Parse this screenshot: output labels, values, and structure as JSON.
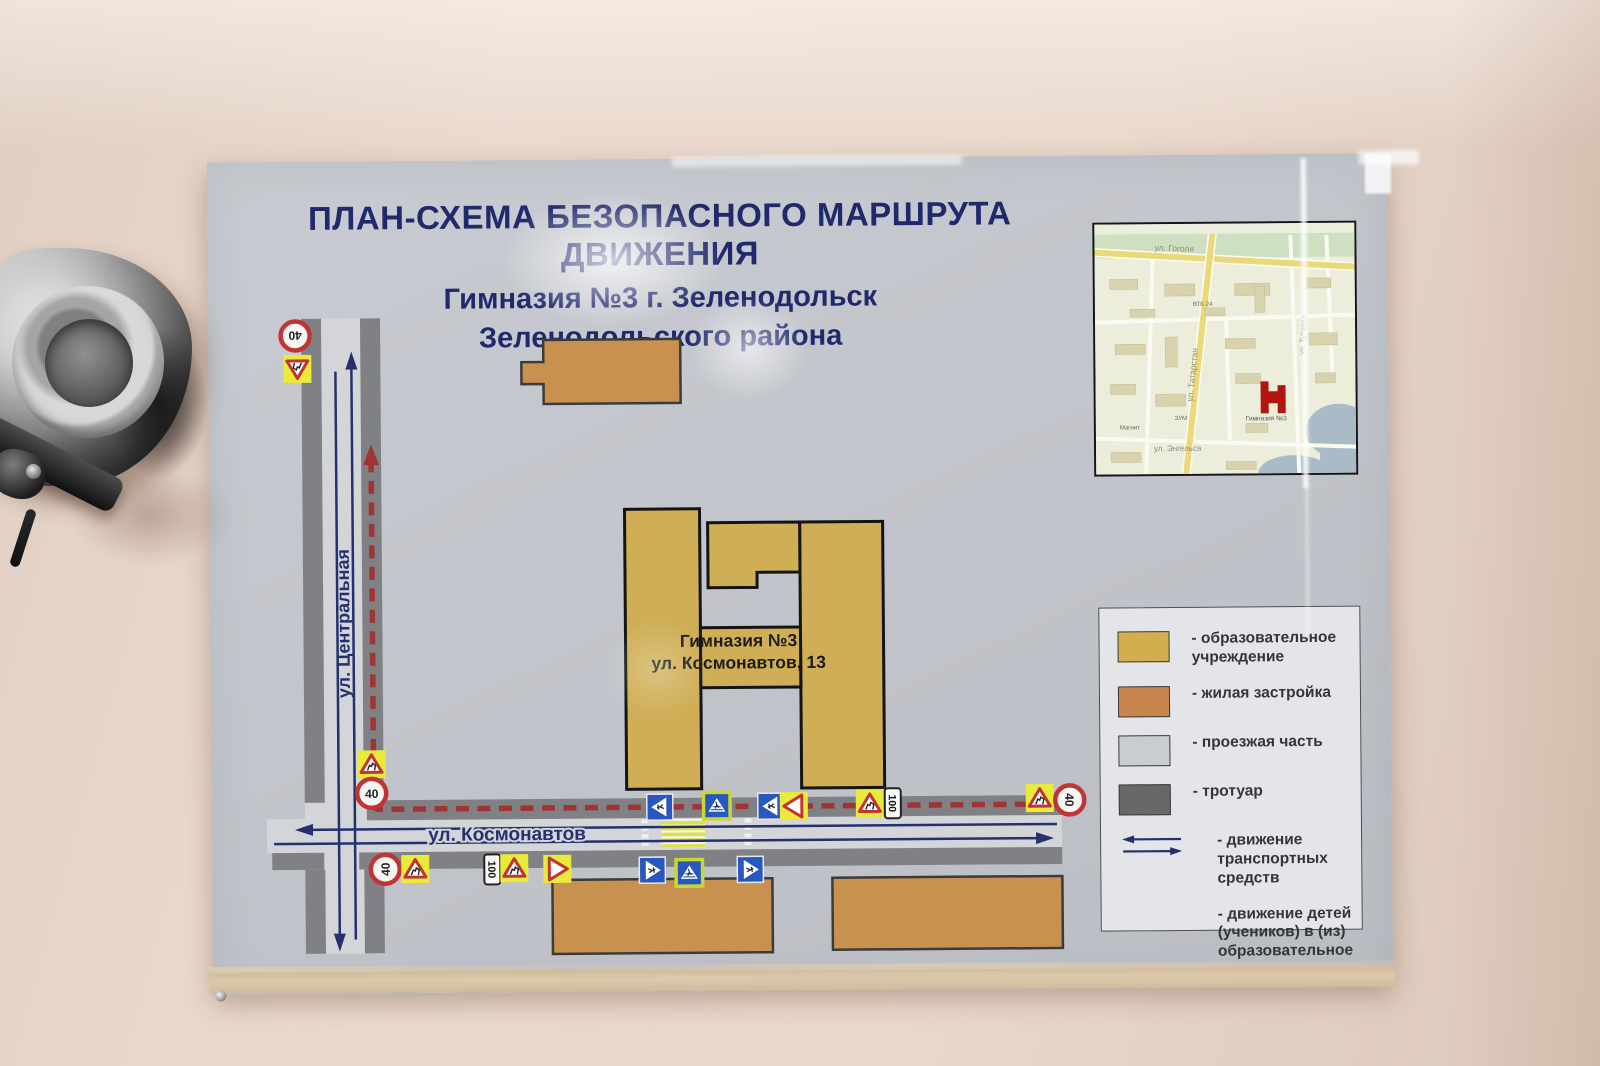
{
  "poster": {
    "title_line1": "ПЛАН-СХЕМА БЕЗОПАСНОГО МАРШРУТА ДВИЖЕНИЯ",
    "title_line2": "Гимназия №3 г. Зеленодольск",
    "title_line3": "Зеленодольского района"
  },
  "map": {
    "street_vertical": "ул. Центральная",
    "street_horizontal": "ул. Космонавтов",
    "school": {
      "line1": "Гимназия №3",
      "line2": "ул. Космонавтов, 13",
      "color": "#cfae55"
    },
    "colors": {
      "residential": "#c9914f",
      "roadway": "#d3d5d9",
      "sidewalk": "#7f8184",
      "route": "#a03434",
      "traffic_arrows": "#26306e"
    },
    "sign_text": {
      "speed": "40",
      "distance": "100"
    },
    "signs": [
      {
        "type": "speed40",
        "x": 87,
        "y": 174,
        "rot": 180
      },
      {
        "type": "children",
        "x": 89,
        "y": 207,
        "rot": 180
      },
      {
        "type": "children",
        "x": 160,
        "y": 603,
        "rot": 0
      },
      {
        "type": "speed40",
        "x": 160,
        "y": 632,
        "rot": 0
      },
      {
        "type": "ped",
        "x": 448,
        "y": 648,
        "rot": -90
      },
      {
        "type": "pedcross",
        "x": 505,
        "y": 647,
        "rot": 0
      },
      {
        "type": "ped",
        "x": 559,
        "y": 648,
        "rot": -90
      },
      {
        "type": "giveway",
        "x": 582,
        "y": 648,
        "rot": 90
      },
      {
        "type": "children",
        "x": 658,
        "y": 646,
        "rot": 0
      },
      {
        "type": "plate100",
        "x": 681,
        "y": 646,
        "rot": 90
      },
      {
        "type": "children",
        "x": 828,
        "y": 642,
        "rot": 0
      },
      {
        "type": "speed40",
        "x": 858,
        "y": 644,
        "rot": 90
      },
      {
        "type": "speed40",
        "x": 173,
        "y": 708,
        "rot": -90
      },
      {
        "type": "children",
        "x": 203,
        "y": 708,
        "rot": 0
      },
      {
        "type": "plate100",
        "x": 280,
        "y": 709,
        "rot": 90
      },
      {
        "type": "children",
        "x": 302,
        "y": 708,
        "rot": 0
      },
      {
        "type": "giveway",
        "x": 345,
        "y": 709,
        "rot": -90
      },
      {
        "type": "ped",
        "x": 440,
        "y": 711,
        "rot": 90
      },
      {
        "type": "pedcross",
        "x": 477,
        "y": 714,
        "rot": 0
      },
      {
        "type": "ped",
        "x": 538,
        "y": 711,
        "rot": 90
      }
    ]
  },
  "inset_map": {
    "street_gogolya": "ул. Гоголя",
    "street_tatarstan": "ул. Татарстан",
    "street_tutaeva": "ул. Тутаева",
    "street_engelsa": "ул. Энгельса",
    "school_marker_label": "Гимназия №3",
    "poi_vtb": "ВТБ 24",
    "poi_magnit": "Магнит",
    "poi_zum": "ЗУМ"
  },
  "legend": {
    "items": [
      {
        "symbol": "swatch",
        "color": "#d2ae4e",
        "label": "- образовательное\nучреждение"
      },
      {
        "symbol": "swatch",
        "color": "#c8864e",
        "label": "- жилая застройка"
      },
      {
        "symbol": "swatch",
        "color": "#c9ccd0",
        "label": "- проезжая часть"
      },
      {
        "symbol": "swatch",
        "color": "#66686a",
        "label": "- тротуар"
      },
      {
        "symbol": "arrows",
        "color": "#26306e",
        "label": "- движение\nтранспортных средств"
      },
      {
        "symbol": "none",
        "color": "",
        "label": "- движение детей\n(учеников) в (из)\nобразовательное\nучреждение"
      }
    ]
  }
}
